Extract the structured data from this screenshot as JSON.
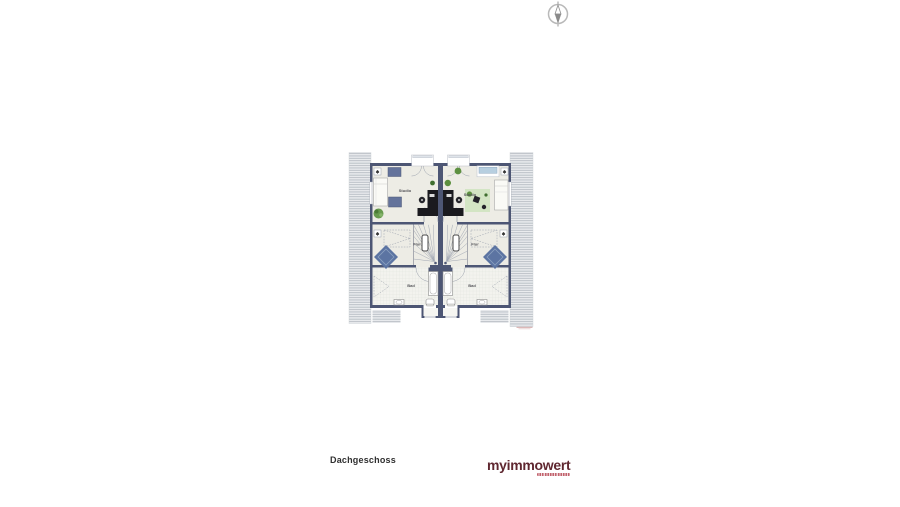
{
  "page": {
    "background_color": "#ffffff"
  },
  "compass": {
    "icon": "north-arrow"
  },
  "floor_plan": {
    "colors": {
      "wall": "#4d5674",
      "floor": "#edece5",
      "roof_hatch_line": "#b2b8c0",
      "accent_blue": "#5c74a2",
      "window_glass": "#b7cfe0",
      "rug_green": "#d3e5c4",
      "plant_green": "#5d9040",
      "desk_black": "#1a1a1f"
    },
    "units": [
      {
        "side": "left",
        "rooms": [
          {
            "label": "Studio"
          },
          {
            "label": "Flur"
          },
          {
            "label": "Bad"
          }
        ]
      },
      {
        "side": "right",
        "rooms": [
          {
            "label": "Studio"
          },
          {
            "label": "Flur"
          },
          {
            "label": "Bad"
          }
        ]
      }
    ]
  },
  "footer": {
    "floor_label": "Dachgeschoss",
    "logo_text": "myimmowert"
  }
}
